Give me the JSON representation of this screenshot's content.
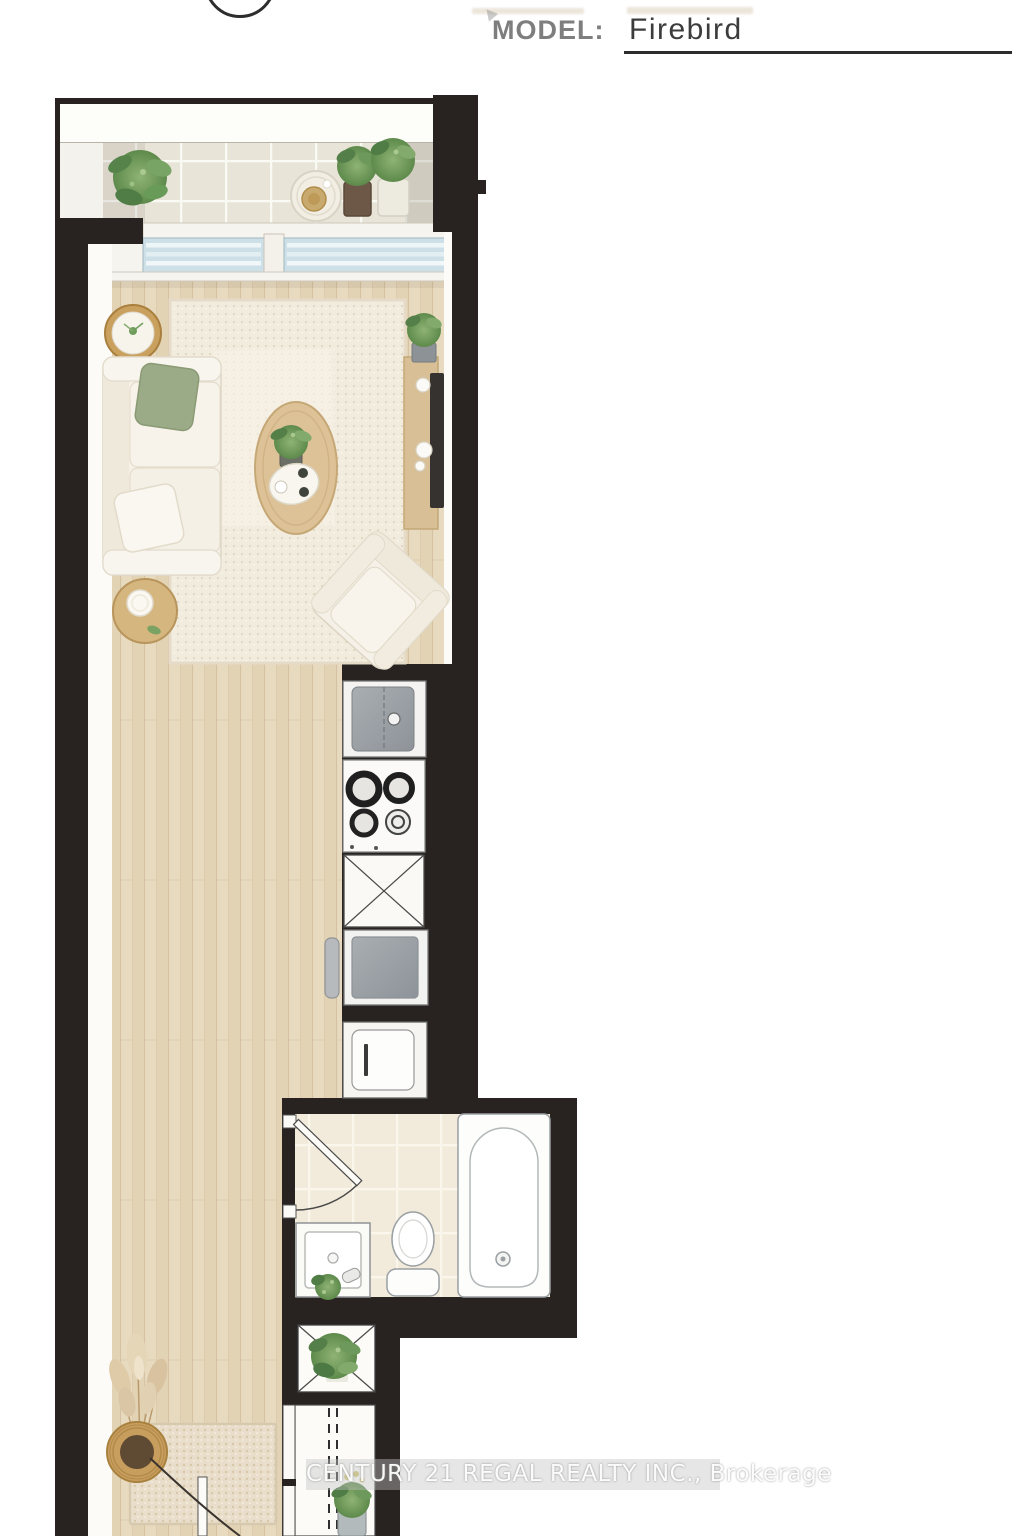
{
  "header": {
    "model_label": "MODEL:",
    "model_value": "Firebird"
  },
  "watermark": {
    "text": "CENTURY 21 REGAL REALTY INC., Brokerage"
  },
  "floorplan": {
    "type": "studio-condo-floor-plan",
    "areas": [
      "balcony",
      "living-area",
      "kitchen",
      "bathroom",
      "closets",
      "entry"
    ],
    "fixtures": {
      "balcony": [
        "potted-plants",
        "bistro-table",
        "tile-floor",
        "sliding-glass-door"
      ],
      "living": [
        "sectional-sofa",
        "throw-pillows",
        "area-rug",
        "oval-coffee-table",
        "round-side-tables",
        "tv-console",
        "tv",
        "armchair",
        "potted-plants"
      ],
      "kitchen": [
        "refrigerator",
        "cooktop-4-burner",
        "counter-cabinet",
        "sink",
        "dishwasher-cabinet"
      ],
      "bathroom": [
        "swing-door",
        "vanity-sink",
        "toilet",
        "bathtub",
        "tile-floor"
      ],
      "closets": [
        "shelf-unit-x-symbol",
        "double-dashed-hanging-rail",
        "potted-plants"
      ],
      "entry": [
        "entry-door-swing",
        "doormat",
        "pampas-grass-basket"
      ]
    },
    "colors": {
      "wall": "#282220",
      "wood_floor": "#e7d9c0",
      "balcony_tile": "#e9e4d8",
      "bath_tile": "#f2ebdb",
      "rug": "#f2ecdf",
      "glass": "#cde0e8",
      "accent_green": "#6f9e5c"
    }
  }
}
